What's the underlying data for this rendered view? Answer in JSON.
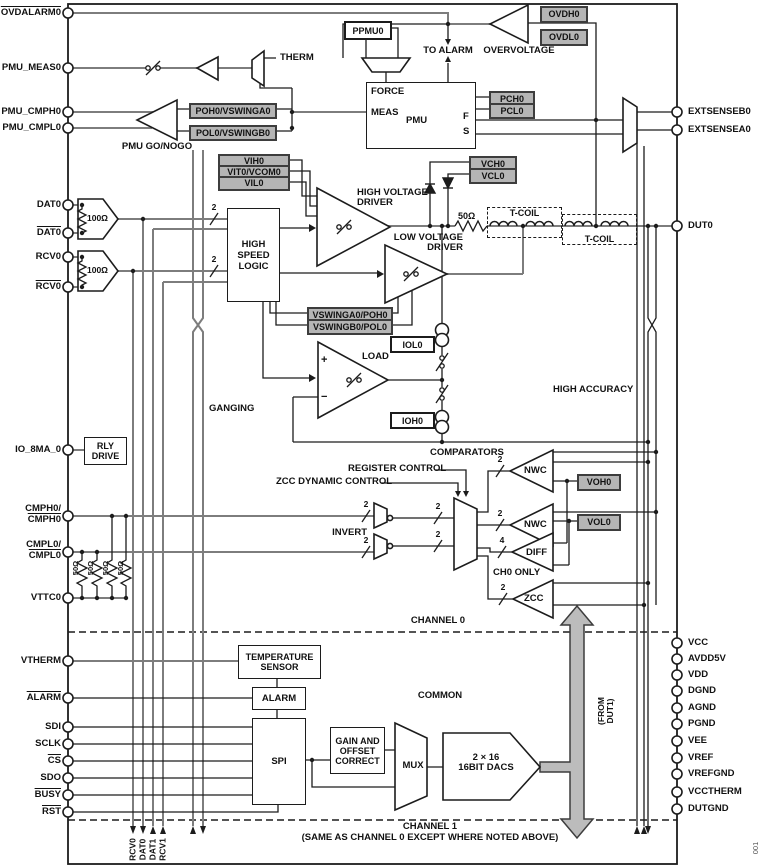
{
  "figure": {
    "id": "001"
  },
  "pins": {
    "left": [
      {
        "label": "OVDALARM0",
        "bar": true
      },
      {
        "label": "PMU_MEAS0"
      },
      {
        "label": "PMU_CMPH0"
      },
      {
        "label": "PMU_CMPL0"
      },
      {
        "label": "DAT0"
      },
      {
        "label": "DAT0",
        "bar": true
      },
      {
        "label": "RCV0"
      },
      {
        "label": "RCV0",
        "bar": true
      },
      {
        "label": "IO_8MA_0"
      },
      {
        "label": "CMPH0/",
        "label2": "CMPH0"
      },
      {
        "label": "CMPL0/",
        "label2": "CMPL0"
      },
      {
        "label": "VTTC0"
      },
      {
        "label": "VTHERM"
      },
      {
        "label": "ALARM",
        "bar": true
      },
      {
        "label": "SDI"
      },
      {
        "label": "SCLK"
      },
      {
        "label": "CS",
        "bar": true
      },
      {
        "label": "SDO"
      },
      {
        "label": "BUSY",
        "bar": true
      },
      {
        "label": "RST",
        "bar": true
      }
    ],
    "right": [
      {
        "label": "EXTSENSEB0"
      },
      {
        "label": "EXTSENSEA0"
      },
      {
        "label": "DUT0"
      },
      {
        "label": "VCC"
      },
      {
        "label": "AVDD5V"
      },
      {
        "label": "VDD"
      },
      {
        "label": "DGND"
      },
      {
        "label": "AGND"
      },
      {
        "label": "PGND"
      },
      {
        "label": "VEE"
      },
      {
        "label": "VREF"
      },
      {
        "label": "VREFGND"
      },
      {
        "label": "VCCTHERM"
      },
      {
        "label": "DUTGND"
      }
    ]
  },
  "params": {
    "ppmu0": "PPMU0",
    "ovdh0": "OVDH0",
    "ovdl0": "OVDL0",
    "pch0": "PCH0",
    "pcl0": "PCL0",
    "poh0": "POH0/VSWINGA0",
    "pol0": "POL0/VSWINGB0",
    "vih0": "VIH0",
    "vit0": "VIT0/VCOM0",
    "vil0": "VIL0",
    "vch0": "VCH0",
    "vcl0": "VCL0",
    "vswinga0": "VSWINGA0/POH0",
    "vswingb0": "VSWINGB0/POL0",
    "voh0": "VOH0",
    "vol0": "VOL0",
    "iol0": "IOL0",
    "ioh0": "IOH0"
  },
  "blocks": {
    "pmu": {
      "name": "PMU",
      "force": "FORCE",
      "meas": "MEAS",
      "f": "F",
      "s": "S"
    },
    "hsl": "HIGH\nSPEED\nLOGIC",
    "rly": "RLY\nDRIVE",
    "temp_sensor": "TEMPERATURE\nSENSOR",
    "alarm": "ALARM",
    "spi": "SPI",
    "gain": "GAIN AND\nOFFSET\nCORRECT",
    "mux": "MUX",
    "dacs": "2 × 16\n16BIT DACS"
  },
  "labels": {
    "therm": "THERM",
    "to_alarm": "TO ALARM",
    "overvoltage": "OVERVOLTAGE",
    "pmu_gonogo": "PMU GO/NOGO",
    "hv_driver": "HIGH VOLTAGE\nDRIVER",
    "lv_driver": "LOW VOLTAGE\nDRIVER",
    "r50": "50Ω",
    "tcoil1": "T-COIL",
    "tcoil2": "T-COIL",
    "load": "LOAD",
    "plus": "+",
    "minus": "−",
    "high_accuracy": "HIGH ACCURACY",
    "ganging": "GANGING",
    "register_control": "REGISTER CONTROL",
    "zcc_dynamic": "ZCC DYNAMIC CONTROL",
    "comparators": "COMPARATORS",
    "invert": "INVERT",
    "nwc1": "NWC",
    "nwc2": "NWC",
    "diff": "DIFF",
    "zcc": "ZCC",
    "ch0_only": "CH0 ONLY",
    "channel0": "CHANNEL 0",
    "common": "COMMON",
    "from_dut1": "(FROM\nDUT1)",
    "channel1": "CHANNEL 1",
    "channel1_note": "(SAME AS CHANNEL 0 EXCEPT WHERE NOTED ABOVE)",
    "r100a": "100Ω",
    "r100b": "100Ω",
    "r50a": "50Ω",
    "r50b": "50Ω",
    "r50c": "50Ω",
    "r50d": "50Ω"
  },
  "bus": {
    "two": "2",
    "four": "4"
  },
  "bottom_signals": {
    "s0": "RCV0",
    "s1": "DAT0",
    "s2": "DAT1",
    "s3": "RCV1"
  }
}
